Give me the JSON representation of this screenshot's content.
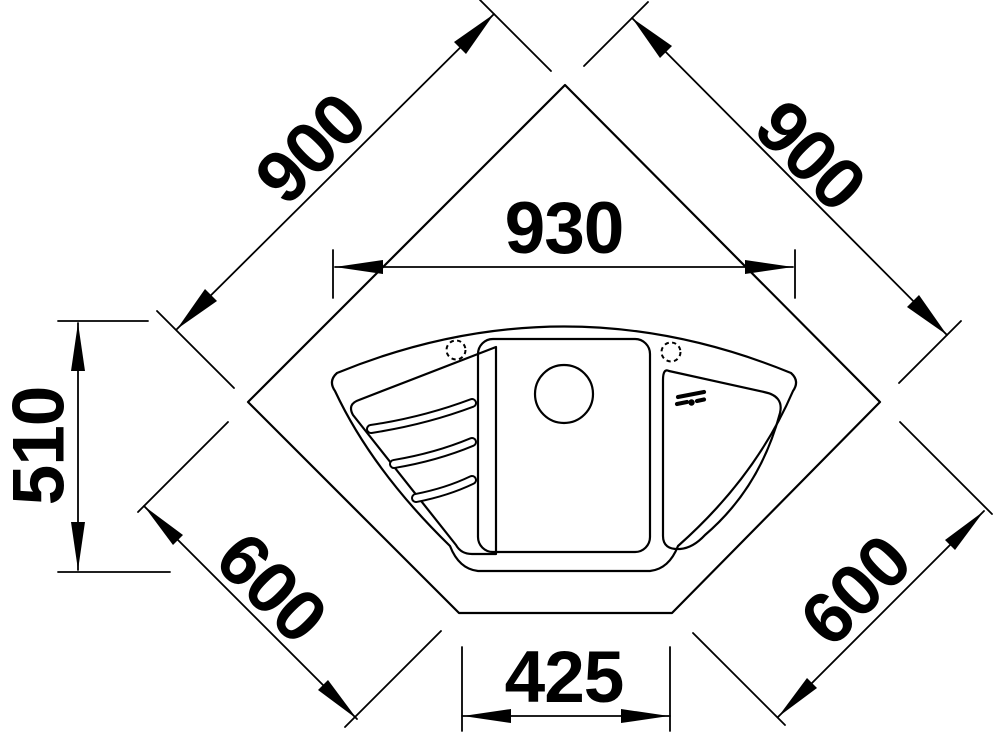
{
  "drawing": {
    "background_color": "#ffffff",
    "line_color": "#000000"
  },
  "dimensions": {
    "countertop_edge_top_left": {
      "value": "900"
    },
    "countertop_edge_top_right": {
      "value": "900"
    },
    "sink_width": {
      "value": "930"
    },
    "sink_depth": {
      "value": "510"
    },
    "edge_bottom_left": {
      "value": "600"
    },
    "edge_bottom_right": {
      "value": "600"
    },
    "front_edge": {
      "value": "425"
    }
  }
}
